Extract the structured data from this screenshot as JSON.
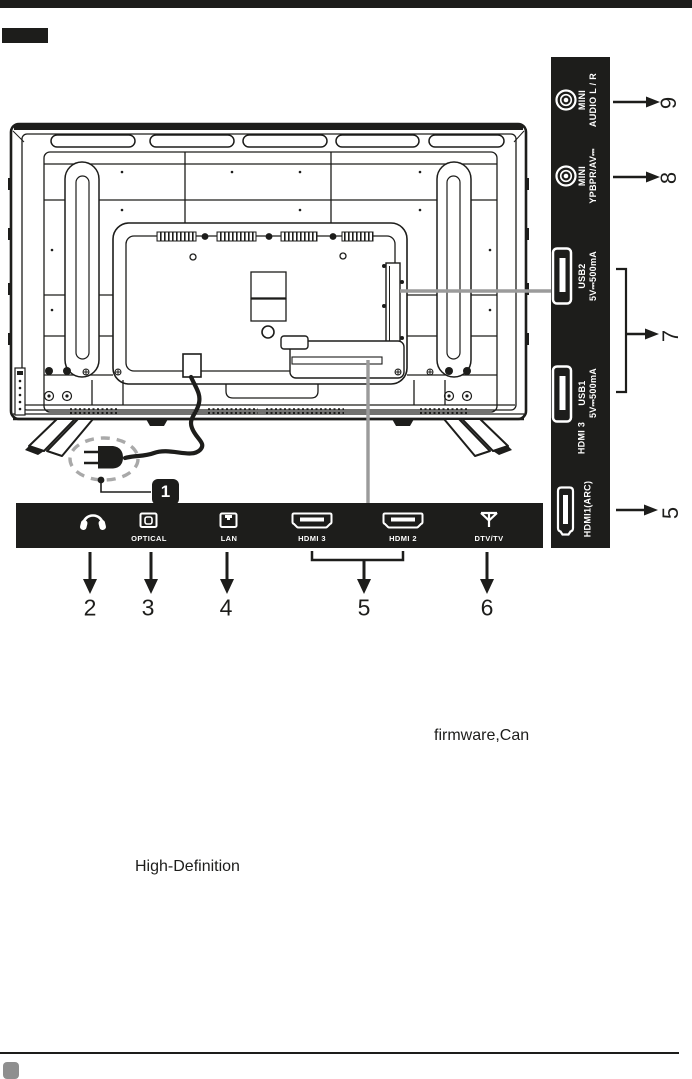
{
  "colors": {
    "ink": "#1d1d1b",
    "panel_black": "#1d1d1b",
    "annotation_gray": "#9b9b9b",
    "highlight_dash_gray": "#a9a9a9",
    "page_corner_gray": "#8f8f8f"
  },
  "plug_callout": {
    "number": "1"
  },
  "right_panel": {
    "ports": [
      {
        "icon": "mini-jack",
        "line1": "MINI",
        "line2": "AUDIO L / R"
      },
      {
        "icon": "mini-jack",
        "line1": "MINI",
        "line2": "YPBPR/AV⎓"
      },
      {
        "icon": "usb",
        "line1": "USB2",
        "line2": "5V⎓500mA"
      },
      {
        "icon": "usb",
        "line1": "USB1",
        "line2": "5V⎓500mA"
      },
      {
        "icon": "none",
        "line1": "HDMI 3",
        "line2": ""
      },
      {
        "icon": "hdmi",
        "line1": "HDMI1(ARC)",
        "line2": ""
      }
    ],
    "callouts": [
      {
        "n": "9"
      },
      {
        "n": "8"
      },
      {
        "n": "7"
      },
      {
        "n": "5"
      }
    ]
  },
  "bottom_panel": {
    "ports": [
      {
        "icon": "headphone",
        "label": ""
      },
      {
        "icon": "optical",
        "label": "OPTICAL"
      },
      {
        "icon": "lan",
        "label": "LAN"
      },
      {
        "icon": "hdmi",
        "label": "HDMI 3"
      },
      {
        "icon": "hdmi",
        "label": "HDMI 2"
      },
      {
        "icon": "antenna",
        "label": "DTV/TV"
      }
    ],
    "callouts": [
      {
        "n": "2"
      },
      {
        "n": "3"
      },
      {
        "n": "4"
      },
      {
        "n": "5"
      },
      {
        "n": "6"
      }
    ]
  },
  "fragments": {
    "firmware": "firmware,Can",
    "high_def": "High-Definition"
  }
}
